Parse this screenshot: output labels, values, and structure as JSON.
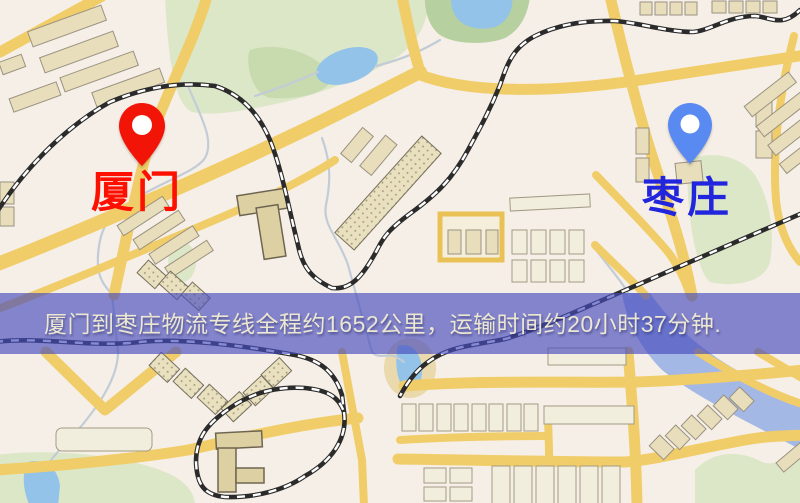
{
  "map": {
    "markers": [
      {
        "id": "origin",
        "label": "厦门",
        "pin_color": "#f31408",
        "label_color": "#fe1000"
      },
      {
        "id": "destination",
        "label": "枣庄",
        "pin_color": "#598af2",
        "label_color": "#2125dd"
      }
    ],
    "banner": {
      "text": "厦门到枣庄物流专线全程约1652公里，运输时间约20小时37分钟."
    }
  },
  "colors": {
    "banner_overlay": "#484cbe",
    "banner_text": "#ece7d2",
    "origin_label": "#fe1000",
    "dest_label": "#2125dd",
    "origin_pin": "#f31408",
    "dest_pin": "#598af2"
  }
}
